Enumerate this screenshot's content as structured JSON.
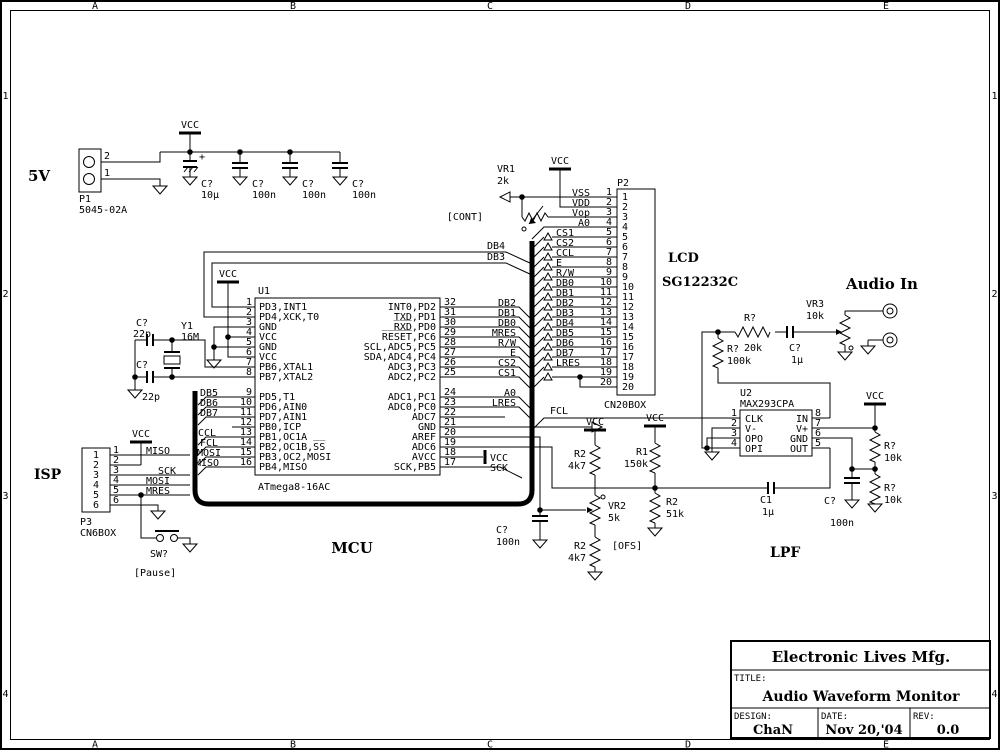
{
  "frame": {
    "cols": [
      "A",
      "B",
      "C",
      "D",
      "E"
    ],
    "rows": [
      "1",
      "2",
      "3",
      "4"
    ]
  },
  "title_block": {
    "company": "Electronic Lives Mfg.",
    "title_label": "TITLE:",
    "title": "Audio Waveform Monitor",
    "design_label": "DESIGN:",
    "design": "ChaN",
    "date_label": "DATE:",
    "date": "Nov 20,'04",
    "rev_label": "REV:",
    "rev": "0.0"
  },
  "power": {
    "label": "5V",
    "vcc": "VCC",
    "p1": {
      "ref": "P1",
      "part": "5045-02A",
      "pin_top": "2",
      "pin_bottom": "1"
    },
    "c1": {
      "ref": "C?",
      "val": "10µ",
      "plus": "+"
    },
    "c2": {
      "ref": "C?",
      "val": "100n"
    },
    "c3": {
      "ref": "C?",
      "val": "100n"
    },
    "c4": {
      "ref": "C?",
      "val": "100n"
    }
  },
  "xtal": {
    "ref": "Y1",
    "val": "16M",
    "c_top": {
      "ref": "C?",
      "val": "22p"
    },
    "c_bot": {
      "ref": "C?",
      "val": "22p"
    }
  },
  "u1": {
    "ref": "U1",
    "part": "ATmega8-16AC",
    "vcc": "VCC",
    "mcu_label": "MCU",
    "left": [
      {
        "n": "1",
        "l": "PD3,INT1"
      },
      {
        "n": "2",
        "l": "PD4,XCK,T0"
      },
      {
        "n": "3",
        "l": "GND"
      },
      {
        "n": "4",
        "l": "VCC"
      },
      {
        "n": "5",
        "l": "GND"
      },
      {
        "n": "6",
        "l": "VCC"
      },
      {
        "n": "7",
        "l": "PB6,XTAL1"
      },
      {
        "n": "8",
        "l": "PB7,XTAL2"
      },
      {
        "n": "9",
        "l": "PD5,T1"
      },
      {
        "n": "10",
        "l": "PD6,AIN0"
      },
      {
        "n": "11",
        "l": "PD7,AIN1"
      },
      {
        "n": "12",
        "l": "PB0,ICP"
      },
      {
        "n": "13",
        "l": "PB1,OC1A"
      },
      {
        "n": "14",
        "l": "PB2,OC1B,S̅S̅"
      },
      {
        "n": "15",
        "l": "PB3,OC2,MOSI"
      },
      {
        "n": "16",
        "l": "PB4,MISO"
      }
    ],
    "right": [
      {
        "n": "32",
        "l": "INT0,PD2",
        "net": "DB2"
      },
      {
        "n": "31",
        "l": "TXD,PD1",
        "net": "DB1"
      },
      {
        "n": "30",
        "l": "R̅X̅D̅,PD0",
        "net": "DB0"
      },
      {
        "n": "29",
        "l": "R̅E̅S̅E̅T̅,PC6",
        "net": "MRES"
      },
      {
        "n": "28",
        "l": "SCL,ADC5,PC5",
        "net": "R/W"
      },
      {
        "n": "27",
        "l": "SDA,ADC4,PC4",
        "net": "E"
      },
      {
        "n": "26",
        "l": "ADC3,PC3",
        "net": "CS2"
      },
      {
        "n": "25",
        "l": "ADC2,PC2",
        "net": "CS1"
      },
      {
        "n": "24",
        "l": "ADC1,PC1",
        "net": "A0"
      },
      {
        "n": "23",
        "l": "ADC0,PC0",
        "net": "LRES"
      },
      {
        "n": "22",
        "l": "ADC7",
        "net": ""
      },
      {
        "n": "21",
        "l": "GND",
        "net": ""
      },
      {
        "n": "20",
        "l": "AREF",
        "net": ""
      },
      {
        "n": "19",
        "l": "ADC6",
        "net": ""
      },
      {
        "n": "18",
        "l": "AVCC",
        "net": "VCC"
      },
      {
        "n": "17",
        "l": "SCK,PB5",
        "net": "SCK"
      }
    ],
    "nets": {
      "db4": "DB4",
      "db3": "DB3"
    }
  },
  "bus_left": [
    "DB5",
    "DB6",
    "DB7",
    "CCL",
    "FCL",
    "MOSI",
    "MISO"
  ],
  "isp": {
    "label": "ISP",
    "ref": "P3",
    "part": "CN6BOX",
    "vcc": "VCC",
    "pins": [
      "1",
      "2",
      "3",
      "4",
      "5",
      "6"
    ],
    "nets": [
      "MISO",
      "",
      "SCK",
      "MOSI",
      "MRES",
      ""
    ],
    "sw": {
      "ref": "SW?",
      "note": "[Pause]"
    }
  },
  "ofs": {
    "vcc": "VCC",
    "note": "[OFS]",
    "r_top": {
      "ref": "R2",
      "val": "4k7"
    },
    "vr": {
      "ref": "VR2",
      "val": "5k"
    },
    "r_bot": {
      "ref": "R2",
      "val": "4k7"
    },
    "c": {
      "ref": "C?",
      "val": "100n"
    }
  },
  "bias": {
    "vcc": "VCC",
    "r1": {
      "ref": "R1",
      "val": "150k"
    },
    "r2": {
      "ref": "R2",
      "val": "51k"
    }
  },
  "fcl": "FCL",
  "p2": {
    "ref": "P2",
    "part": "CN20BOX",
    "lcd": "LCD",
    "lcd_part": "SG12232C",
    "vcc": "VCC",
    "vr1": {
      "ref": "VR1",
      "val": "2k",
      "note": "[CONT]"
    },
    "pins": [
      {
        "n": "1",
        "net": "VSS"
      },
      {
        "n": "2",
        "net": "VDD"
      },
      {
        "n": "3",
        "net": "Vop"
      },
      {
        "n": "4",
        "net": "A0"
      },
      {
        "n": "5",
        "net": "CS1"
      },
      {
        "n": "6",
        "net": "CS2"
      },
      {
        "n": "7",
        "net": "CCL"
      },
      {
        "n": "8",
        "net": "E"
      },
      {
        "n": "9",
        "net": "R/W"
      },
      {
        "n": "10",
        "net": "DB0"
      },
      {
        "n": "11",
        "net": "DB1"
      },
      {
        "n": "12",
        "net": "DB2"
      },
      {
        "n": "13",
        "net": "DB3"
      },
      {
        "n": "14",
        "net": "DB4"
      },
      {
        "n": "15",
        "net": "DB5"
      },
      {
        "n": "16",
        "net": "DB6"
      },
      {
        "n": "17",
        "net": "DB7"
      },
      {
        "n": "18",
        "net": "LRES"
      },
      {
        "n": "19",
        "net": ""
      },
      {
        "n": "20",
        "net": ""
      }
    ]
  },
  "u2": {
    "ref": "U2",
    "part": "MAX293CPA",
    "lpf": "LPF",
    "left": [
      {
        "n": "1",
        "l": "CLK"
      },
      {
        "n": "2",
        "l": "V-"
      },
      {
        "n": "3",
        "l": "OPO"
      },
      {
        "n": "4",
        "l": "OPI"
      }
    ],
    "right": [
      {
        "n": "8",
        "l": "IN"
      },
      {
        "n": "7",
        "l": "V+"
      },
      {
        "n": "6",
        "l": "GND"
      },
      {
        "n": "5",
        "l": "OUT"
      }
    ],
    "c1": {
      "ref": "C1",
      "val": "1µ"
    }
  },
  "audio": {
    "label": "Audio In",
    "r_series": {
      "ref": "R?",
      "val": "20k"
    },
    "r_shunt": {
      "ref": "R?",
      "val": "100k"
    },
    "c": {
      "ref": "C?",
      "val": "1µ"
    },
    "vr3": {
      "ref": "VR3",
      "val": "10k"
    }
  },
  "divider": {
    "vcc": "VCC",
    "r_top": {
      "ref": "R?",
      "val": "10k"
    },
    "r_bot": {
      "ref": "R?",
      "val": "10k"
    },
    "c": {
      "ref": "C?",
      "val": "100n"
    }
  }
}
